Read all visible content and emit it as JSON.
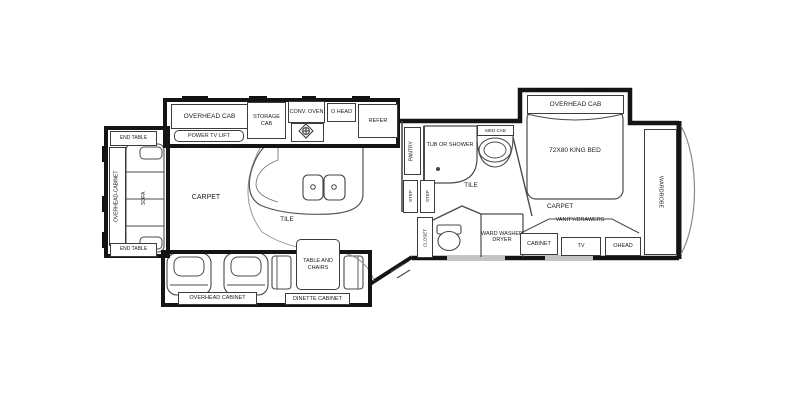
{
  "plan_title": "Fifth Wheel RV Floor Plan",
  "colors": {
    "wall": "#141414",
    "furniture_line": "#4a4a4a",
    "light_line": "#9a9a9a",
    "background": "#ffffff"
  },
  "rear_slide": {
    "end_table_top": "END TABLE",
    "overhead_cabinet": "OVERHEAD-CABINET",
    "sofa": "SOFA",
    "end_table_bottom": "END TABLE"
  },
  "entertainment": {
    "overhead_cab": "OVERHEAD CAB",
    "power_tv_lift": "POWER TV LIFT",
    "fireplace_option": "FIREPLACE OPTION"
  },
  "kitchen": {
    "storage_cab": "STORAGE CAB",
    "conv_oven": "CONV. OVEN",
    "o_head": "O HEAD",
    "refer": "REFER",
    "carpet": "CARPET",
    "tile": "TILE"
  },
  "bathroom": {
    "pantry": "PANTRY",
    "tub_or_shower": "TUB OR SHOWER",
    "med_cab": "MED CAB",
    "tile": "TILE",
    "step_1": "STEP",
    "step_2": "STEP",
    "closet": "CLOSET"
  },
  "utility": {
    "ward_washer_dryer": "WARD WASHER DRYER"
  },
  "bedroom": {
    "overhead_cab": "OVERHEAD CAB",
    "king_bed": "72X80 KING BED",
    "carpet": "CARPET",
    "vanity_drawers": "VANITY/DRAWERS",
    "cabinet": "CABINET",
    "tv": "TV",
    "ohead": "OHEAD",
    "wardrobe": "WARDROBE"
  },
  "dinette": {
    "table_and_chairs": "TABLE AND CHAIRS",
    "overhead_cabinet": "OVERHEAD CABINET",
    "dinette_cabinet": "DINETTE CABINET"
  }
}
